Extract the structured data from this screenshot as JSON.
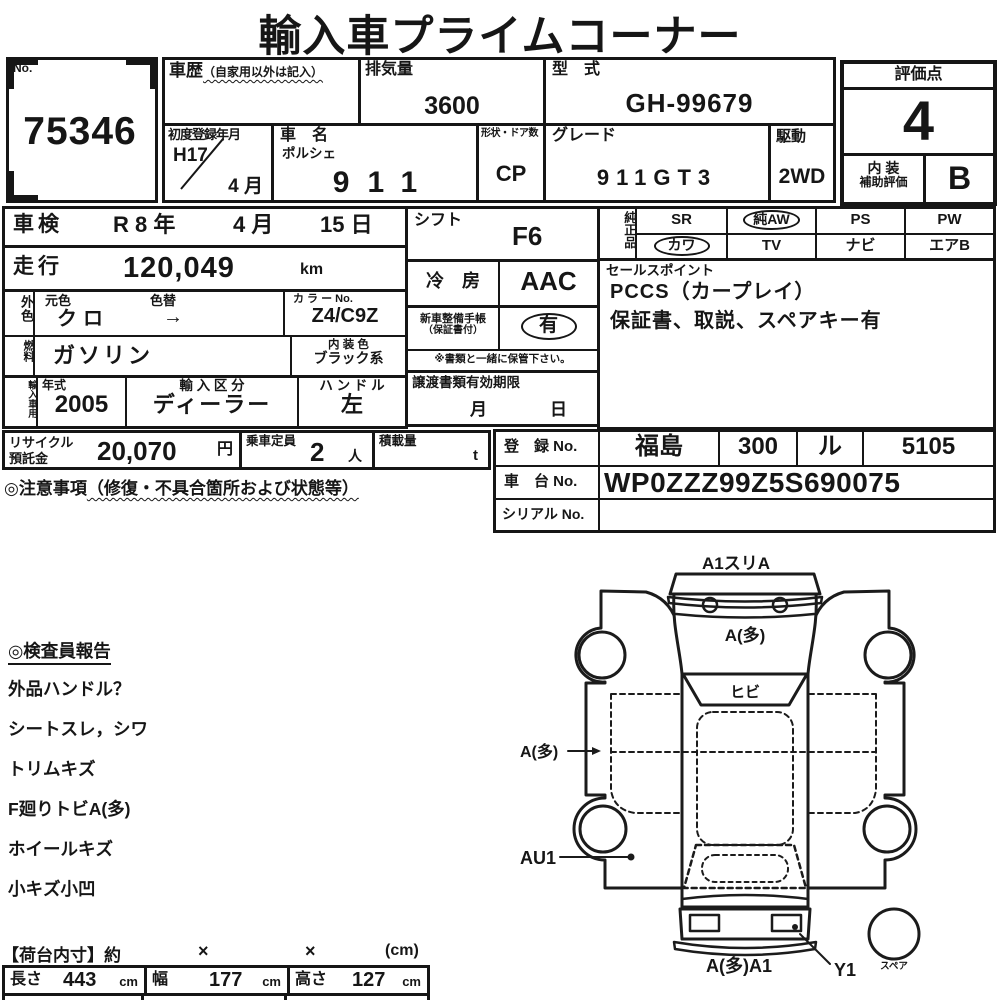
{
  "title": "輸入車プライムコーナー",
  "no_box": {
    "label": "No.",
    "value": "75346"
  },
  "history": {
    "label": "車歴",
    "note": "（自家用以外は記入）"
  },
  "displacement": {
    "label": "排気量",
    "value": "3600"
  },
  "model_code": {
    "label": "型　式",
    "value": "GH-99679"
  },
  "first_reg": {
    "label": "初度登録年月",
    "year": "H17",
    "month": "4 月"
  },
  "car_name": {
    "label": "車　名",
    "maker": "ポルシェ",
    "value": "911"
  },
  "body_doors": {
    "label": "形状・ドア数",
    "value": "CP"
  },
  "grade": {
    "label": "グレード",
    "value": "911GT3"
  },
  "drive": {
    "label": "駆動",
    "value": "2WD"
  },
  "score": {
    "label": "評価点",
    "value": "4",
    "interior_label_1": "内 装",
    "interior_label_2": "補助評価",
    "interior_value": "B"
  },
  "shaken": {
    "label": "車検",
    "year": "R 8 年",
    "month": "4 月",
    "day": "15 日"
  },
  "mileage": {
    "label": "走行",
    "value": "120,049",
    "unit": "km"
  },
  "ext_color": {
    "label": "外色",
    "base_label": "元色",
    "base_value": "クロ",
    "change_label": "色替",
    "change_value": "→",
    "color_no_label": "カ ラ ー No.",
    "color_no_value": "Z4/C9Z"
  },
  "fuel": {
    "label": "燃料",
    "value": "ガソリン",
    "interior_color_label": "内 装 色",
    "interior_color_value": "ブラック系"
  },
  "import_info": {
    "label": "輸入車用",
    "year_label": "年式",
    "year_value": "2005",
    "category_label": "輸 入 区 分",
    "category_value": "ディーラー",
    "handle_label": "ハ ン ド ル",
    "handle_value": "左"
  },
  "shift": {
    "label": "シフト",
    "value": "F6"
  },
  "ac": {
    "label": "冷　房",
    "value": "AAC"
  },
  "service_book": {
    "label_1": "新車整備手帳",
    "label_2": "（保証書付）",
    "value": "有",
    "note": "※書類と一緒に保管下さい。"
  },
  "transfer_docs": {
    "label": "譲渡書類有効期限",
    "month": "月",
    "day": "日"
  },
  "genuine": {
    "label": "純正品",
    "items": [
      {
        "text": "SR",
        "circled": false
      },
      {
        "text": "純AW",
        "circled": true
      },
      {
        "text": "PS",
        "circled": false
      },
      {
        "text": "PW",
        "circled": false
      },
      {
        "text": "カワ",
        "circled": true
      },
      {
        "text": "TV",
        "circled": false
      },
      {
        "text": "ナビ",
        "circled": false
      },
      {
        "text": "エアB",
        "circled": false
      }
    ]
  },
  "sales_points": {
    "label": "セールスポイント",
    "lines": [
      "PCCS（カープレイ）",
      "保証書、取説、スペアキー有"
    ]
  },
  "recycle": {
    "label_1": "リサイクル",
    "label_2": "預託金",
    "value": "20,070",
    "unit": "円"
  },
  "capacity": {
    "label": "乗車定員",
    "value": "2",
    "unit": "人"
  },
  "load": {
    "label": "積載量",
    "unit": "t"
  },
  "caution": {
    "label": "◎注意事項",
    "note": "（修復・不具合箇所および状態等）"
  },
  "registration": {
    "reg_label": "登　録 No.",
    "reg_values": [
      "福島",
      "300",
      "ル",
      "5105"
    ],
    "chassis_label": "車　台 No.",
    "chassis_value": "WP0ZZZ99Z5S690075",
    "serial_label": "シリアル No.",
    "serial_value": ""
  },
  "inspector": {
    "title": "◎検査員報告",
    "items": [
      "外品ハンドル？",
      "シートスレ，シワ",
      "トリムキズ",
      "F廻りトビA(多)",
      "ホイールキズ",
      "小キズ小凹"
    ]
  },
  "cargo": {
    "header_label": "【荷台内寸】約",
    "x1": "×",
    "x2": "×",
    "unit_note": "(cm)",
    "cells": [
      {
        "label": "長さ",
        "value": "443",
        "unit": "cm"
      },
      {
        "label": "幅",
        "value": "177",
        "unit": "cm"
      },
      {
        "label": "高さ",
        "value": "127",
        "unit": "cm"
      }
    ]
  },
  "diagram": {
    "top_label": "A1スリA",
    "hood_label": "A(多)",
    "windshield_label": "ヒビ",
    "left_door_label": "A(多)",
    "rocker_label": "AU1",
    "rear_label": "A(多)A1",
    "taillight_label": "Y1",
    "spare_label": "スペア"
  }
}
